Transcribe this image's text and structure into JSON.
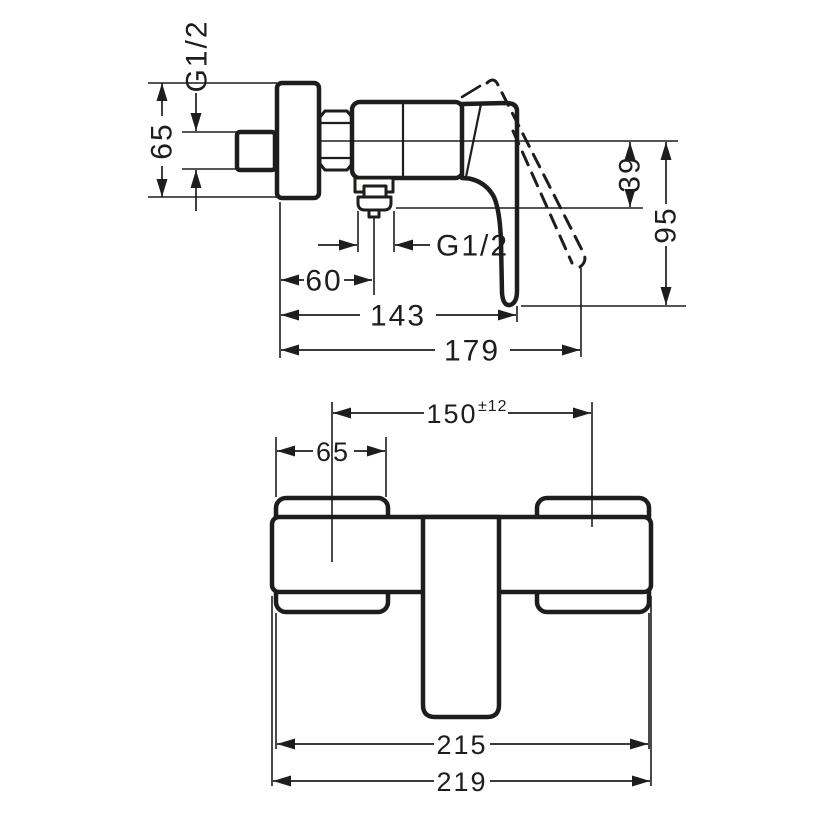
{
  "drawing": {
    "background": "#ffffff",
    "line_color": "#1d1d1b",
    "views": {
      "side": {
        "name": "side-elevation",
        "dims": {
          "wall_thread": "G1/2",
          "escutcheon_height": "65",
          "center_to_outlet": "39",
          "center_to_handle_end": "95",
          "outlet_thread": "G1/2",
          "wall_to_outlet_center": "60",
          "depth_handle_closed": "143",
          "depth_handle_open": "179"
        }
      },
      "front": {
        "name": "front-elevation",
        "dims": {
          "connection_distance": "150",
          "connection_tolerance": "±12",
          "escutcheon_width": "65",
          "body_width": "215",
          "overall_width": "219"
        }
      }
    }
  }
}
